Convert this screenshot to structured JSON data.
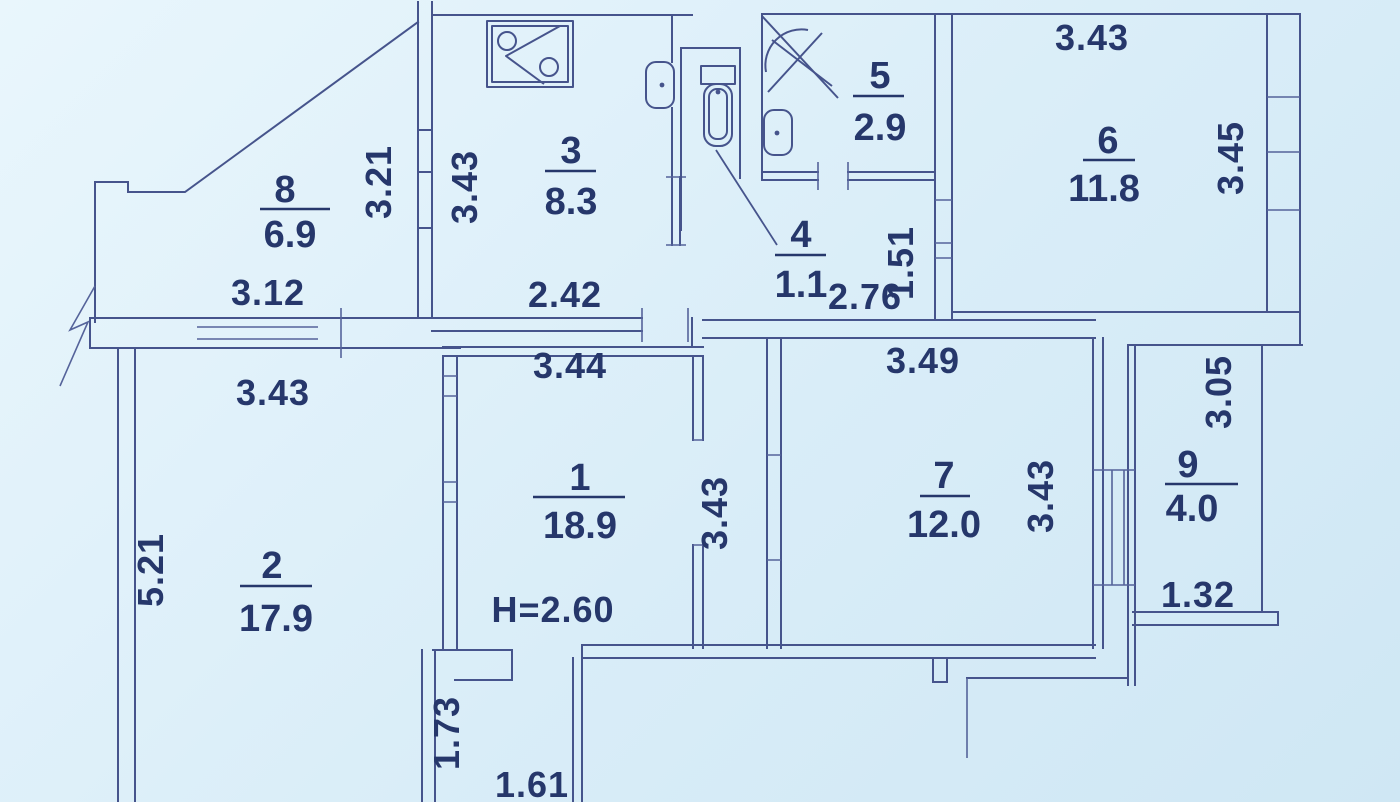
{
  "plan": {
    "type": "apartment-floor-plan",
    "ceiling_height_label": "H=2.60",
    "rooms": [
      {
        "number": "1",
        "area": "18.9"
      },
      {
        "number": "2",
        "area": "17.9"
      },
      {
        "number": "3",
        "area": "8.3"
      },
      {
        "number": "4",
        "area": "1.1"
      },
      {
        "number": "5",
        "area": "2.9"
      },
      {
        "number": "6",
        "area": "11.8"
      },
      {
        "number": "7",
        "area": "12.0"
      },
      {
        "number": "8",
        "area": "6.9"
      },
      {
        "number": "9",
        "area": "4.0"
      }
    ],
    "dims": {
      "room8_width": "3.12",
      "room8_height": "3.21",
      "room2_top": "3.43",
      "room2_left": "5.21",
      "kitchen_left": "3.43",
      "kitchen_bottom": "2.42",
      "room1_top": "3.44",
      "corridor_right": "3.43",
      "lobby_width": "2.76",
      "lobby_height": "1.51",
      "room7_top": "3.49",
      "room7_right": "3.43",
      "room6_top": "3.43",
      "room6_right": "3.45",
      "room9_right": "3.05",
      "room9_bottom": "1.32",
      "hall_height": "1.73",
      "hall_width": "1.61"
    },
    "fixtures": [
      {
        "name": "kitchen-sink-icon",
        "room": "3"
      },
      {
        "name": "wash-basin-icon",
        "room": "4"
      },
      {
        "name": "toilet-icon",
        "room": "4"
      },
      {
        "name": "shower-icon",
        "room": "5"
      },
      {
        "name": "wash-basin-icon",
        "room": "5"
      }
    ],
    "symbols": [
      "wall-break-icon"
    ],
    "colors": {
      "paper": "#d9edf8",
      "line": "#46548c",
      "text": "#26376b"
    }
  }
}
